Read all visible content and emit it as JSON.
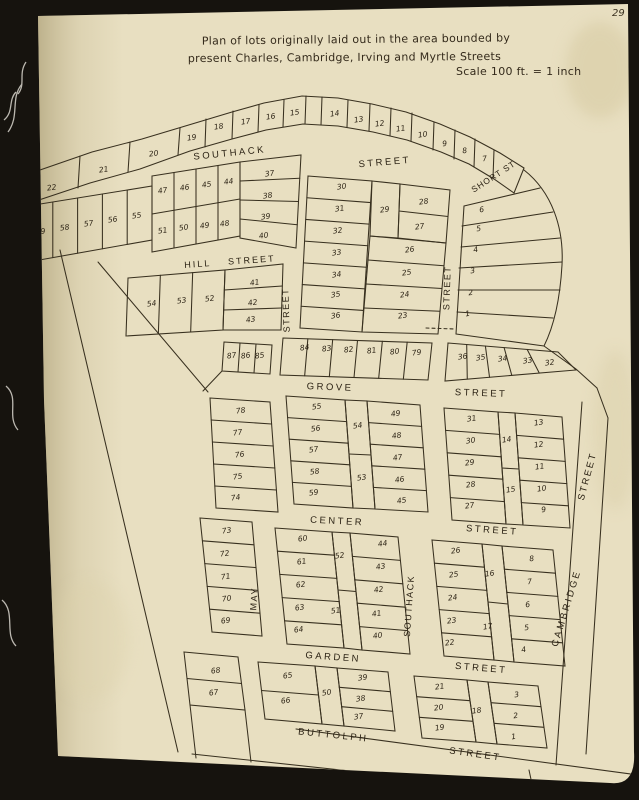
{
  "photo": {
    "background_color": "#16130e",
    "page_color": "#e8dfc1",
    "line_color": "#38301f",
    "ink_color": "#2b2214"
  },
  "page": {
    "number": "29",
    "title_line1": "Plan of lots originally laid out in the area bounded by",
    "title_line2": "present Charles, Cambridge, Irving and Myrtle Streets",
    "scale_note": "Scale 100 ft. = 1 inch"
  },
  "street_labels": [
    {
      "text": "SOUTHACK",
      "x": 230,
      "y": 156,
      "r": -6,
      "size": 9.5,
      "sp": 2.5
    },
    {
      "text": "STREET",
      "x": 385,
      "y": 165,
      "r": -5,
      "size": 9.5,
      "sp": 2.5
    },
    {
      "text": "SHORT ST",
      "x": 495,
      "y": 179,
      "r": -33,
      "size": 8.5,
      "sp": 1
    },
    {
      "text": "HILL",
      "x": 198,
      "y": 267,
      "r": -4,
      "size": 9,
      "sp": 2
    },
    {
      "text": "STREET",
      "x": 252,
      "y": 263,
      "r": -4,
      "size": 9,
      "sp": 2
    },
    {
      "text": "STREET",
      "x": 289,
      "y": 310,
      "r": -92,
      "size": 9,
      "sp": 1.5
    },
    {
      "text": "STREET",
      "x": 450,
      "y": 288,
      "r": -88,
      "size": 9,
      "sp": 1.5
    },
    {
      "text": "GROVE",
      "x": 330,
      "y": 390,
      "r": 2,
      "size": 9.5,
      "sp": 2.5
    },
    {
      "text": "STREET",
      "x": 481,
      "y": 396,
      "r": 2,
      "size": 9.5,
      "sp": 2.5
    },
    {
      "text": "STREET",
      "x": 590,
      "y": 477,
      "r": -75,
      "size": 9.5,
      "sp": 2
    },
    {
      "text": "CENTER",
      "x": 337,
      "y": 524,
      "r": 3,
      "size": 9.5,
      "sp": 2.5
    },
    {
      "text": "STREET",
      "x": 492,
      "y": 533,
      "r": 4,
      "size": 9.5,
      "sp": 2.5
    },
    {
      "text": "MAY",
      "x": 257,
      "y": 599,
      "r": -86,
      "size": 9,
      "sp": 1.5
    },
    {
      "text": "SOUTHACK",
      "x": 412,
      "y": 606,
      "r": -86,
      "size": 9,
      "sp": 1.5
    },
    {
      "text": "CAMBRIDGE",
      "x": 569,
      "y": 609,
      "r": -73,
      "size": 9.5,
      "sp": 2.5
    },
    {
      "text": "GARDEN",
      "x": 333,
      "y": 660,
      "r": 4,
      "size": 9.5,
      "sp": 2.5
    },
    {
      "text": "STREET",
      "x": 481,
      "y": 671,
      "r": 5,
      "size": 9.5,
      "sp": 2.5
    },
    {
      "text": "BUTTOLPH",
      "x": 333,
      "y": 738,
      "r": 6,
      "size": 9.5,
      "sp": 2.5
    },
    {
      "text": "STREET",
      "x": 475,
      "y": 757,
      "r": 8,
      "size": 9.5,
      "sp": 2.5
    }
  ],
  "lots": [
    [
      "22",
      52,
      190
    ],
    [
      "21",
      104,
      172
    ],
    [
      "20",
      154,
      156
    ],
    [
      "19",
      192,
      140
    ],
    [
      "18",
      219,
      129
    ],
    [
      "17",
      246,
      124
    ],
    [
      "16",
      271,
      119
    ],
    [
      "15",
      295,
      115
    ],
    [
      "14",
      335,
      116
    ],
    [
      "13",
      359,
      122
    ],
    [
      "12",
      380,
      126
    ],
    [
      "11",
      401,
      131
    ],
    [
      "10",
      423,
      137
    ],
    [
      "9",
      445,
      146
    ],
    [
      "8",
      465,
      153
    ],
    [
      "7",
      485,
      161
    ],
    [
      "59",
      41,
      234
    ],
    [
      "58",
      65,
      230
    ],
    [
      "57",
      89,
      226
    ],
    [
      "56",
      113,
      222
    ],
    [
      "55",
      137,
      218
    ],
    [
      "47",
      163,
      193
    ],
    [
      "46",
      185,
      190
    ],
    [
      "45",
      207,
      187
    ],
    [
      "44",
      229,
      184
    ],
    [
      "51",
      163,
      233
    ],
    [
      "50",
      184,
      230
    ],
    [
      "49",
      205,
      228
    ],
    [
      "48",
      225,
      226
    ],
    [
      "37",
      270,
      176
    ],
    [
      "38",
      268,
      198
    ],
    [
      "39",
      266,
      219
    ],
    [
      "40",
      264,
      238
    ],
    [
      "54",
      152,
      306
    ],
    [
      "53",
      182,
      303
    ],
    [
      "52",
      210,
      301
    ],
    [
      "41",
      255,
      285
    ],
    [
      "42",
      253,
      305
    ],
    [
      "43",
      251,
      322
    ],
    [
      "30",
      342,
      189
    ],
    [
      "31",
      340,
      211
    ],
    [
      "32",
      338,
      233
    ],
    [
      "33",
      337,
      255
    ],
    [
      "34",
      337,
      277
    ],
    [
      "35",
      336,
      297
    ],
    [
      "36",
      336,
      318
    ],
    [
      "29",
      385,
      212
    ],
    [
      "28",
      424,
      204
    ],
    [
      "27",
      420,
      229
    ],
    [
      "26",
      410,
      252
    ],
    [
      "25",
      407,
      275
    ],
    [
      "24",
      405,
      297
    ],
    [
      "23",
      403,
      318
    ],
    [
      "6",
      482,
      212
    ],
    [
      "5",
      479,
      231
    ],
    [
      "4",
      476,
      252
    ],
    [
      "3",
      473,
      273
    ],
    [
      "2",
      471,
      295
    ],
    [
      "1",
      468,
      316
    ],
    [
      "87",
      232,
      358
    ],
    [
      "86",
      246,
      358
    ],
    [
      "85",
      260,
      358
    ],
    [
      "84",
      305,
      350
    ],
    [
      "83",
      327,
      351
    ],
    [
      "82",
      349,
      352
    ],
    [
      "81",
      372,
      353
    ],
    [
      "80",
      395,
      354
    ],
    [
      "79",
      417,
      355
    ],
    [
      "36",
      463,
      359
    ],
    [
      "35",
      481,
      360
    ],
    [
      "34",
      503,
      361
    ],
    [
      "33",
      528,
      363
    ],
    [
      "32",
      550,
      365
    ],
    [
      "78",
      241,
      413
    ],
    [
      "77",
      238,
      435
    ],
    [
      "76",
      240,
      457
    ],
    [
      "75",
      238,
      479
    ],
    [
      "74",
      236,
      500
    ],
    [
      "55",
      317,
      409
    ],
    [
      "56",
      316,
      431
    ],
    [
      "57",
      314,
      452
    ],
    [
      "58",
      315,
      474
    ],
    [
      "59",
      314,
      495
    ],
    [
      "54",
      358,
      428
    ],
    [
      "53",
      362,
      480
    ],
    [
      "49",
      396,
      416
    ],
    [
      "48",
      397,
      438
    ],
    [
      "47",
      398,
      460
    ],
    [
      "46",
      400,
      482
    ],
    [
      "45",
      402,
      503
    ],
    [
      "31",
      472,
      421
    ],
    [
      "30",
      471,
      443
    ],
    [
      "29",
      470,
      465
    ],
    [
      "28",
      471,
      487
    ],
    [
      "27",
      470,
      508
    ],
    [
      "14",
      507,
      442
    ],
    [
      "15",
      511,
      492
    ],
    [
      "13",
      539,
      425
    ],
    [
      "12",
      539,
      447
    ],
    [
      "11",
      540,
      469
    ],
    [
      "10",
      542,
      491
    ],
    [
      "9",
      544,
      512
    ],
    [
      "73",
      227,
      533
    ],
    [
      "72",
      225,
      556
    ],
    [
      "71",
      226,
      579
    ],
    [
      "70",
      227,
      601
    ],
    [
      "69",
      226,
      623
    ],
    [
      "60",
      303,
      541
    ],
    [
      "61",
      302,
      564
    ],
    [
      "62",
      301,
      587
    ],
    [
      "63",
      300,
      610
    ],
    [
      "64",
      299,
      632
    ],
    [
      "52",
      340,
      558
    ],
    [
      "51",
      336,
      613
    ],
    [
      "44",
      383,
      546
    ],
    [
      "43",
      381,
      569
    ],
    [
      "42",
      379,
      592
    ],
    [
      "41",
      377,
      616
    ],
    [
      "40",
      378,
      638
    ],
    [
      "26",
      456,
      553
    ],
    [
      "25",
      454,
      577
    ],
    [
      "24",
      453,
      600
    ],
    [
      "23",
      452,
      623
    ],
    [
      "22",
      450,
      645
    ],
    [
      "16",
      490,
      576
    ],
    [
      "17",
      488,
      629
    ],
    [
      "8",
      532,
      561
    ],
    [
      "7",
      530,
      584
    ],
    [
      "6",
      528,
      607
    ],
    [
      "5",
      527,
      630
    ],
    [
      "4",
      524,
      652
    ],
    [
      "68",
      216,
      673
    ],
    [
      "67",
      214,
      695
    ],
    [
      "65",
      288,
      678
    ],
    [
      "66",
      286,
      703
    ],
    [
      "50",
      327,
      695
    ],
    [
      "39",
      363,
      680
    ],
    [
      "38",
      361,
      701
    ],
    [
      "37",
      359,
      719
    ],
    [
      "21",
      440,
      689
    ],
    [
      "20",
      439,
      710
    ],
    [
      "19",
      440,
      730
    ],
    [
      "18",
      477,
      713
    ],
    [
      "3",
      517,
      697
    ],
    [
      "2",
      516,
      718
    ],
    [
      "1",
      514,
      739
    ]
  ]
}
